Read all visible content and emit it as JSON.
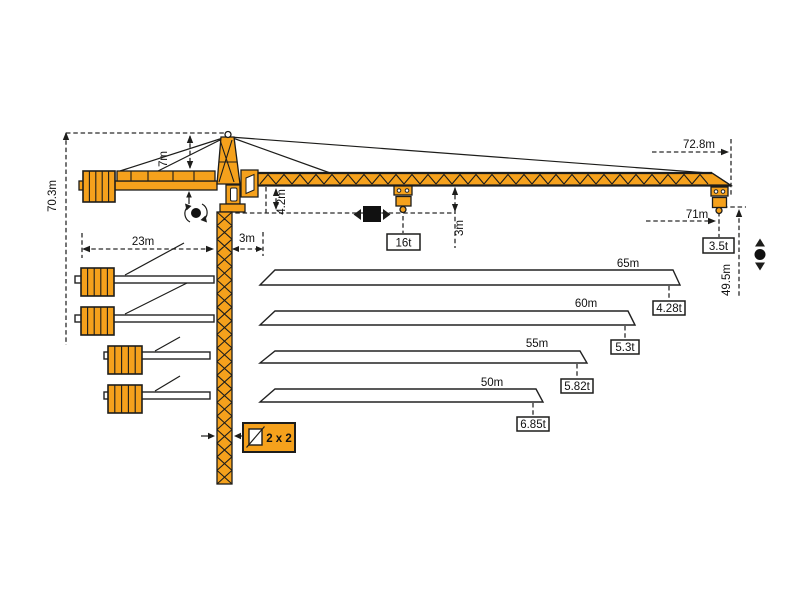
{
  "diagram": {
    "type": "tower-crane-specification-diagram",
    "colors": {
      "crane_orange": "#F5A11C",
      "line": "#1d1d1b",
      "background": "#ffffff"
    },
    "dimensions": {
      "total_height": "70.3m",
      "tower_head_height": "7m",
      "counterjib_radius": "23m",
      "mast_to_pivot": "3m",
      "jib_to_platform": "4.2m",
      "max_capacity": "16t",
      "jib_to_hook": "3m",
      "overall_jib_length": "72.8m",
      "max_working_radius": "71m",
      "tip_capacity": "3.5t",
      "hook_height": "49.5m",
      "mast_cross_section": "2 x 2"
    },
    "jib_variants": [
      {
        "length": "65m",
        "tip_capacity": "4.28t"
      },
      {
        "length": "60m",
        "tip_capacity": "5.3t"
      },
      {
        "length": "55m",
        "tip_capacity": "5.82t"
      },
      {
        "length": "50m",
        "tip_capacity": "6.85t"
      }
    ],
    "icons": [
      "slewing-icon",
      "trolley-travel-icon",
      "hoist-icon",
      "mast-section-icon"
    ]
  }
}
